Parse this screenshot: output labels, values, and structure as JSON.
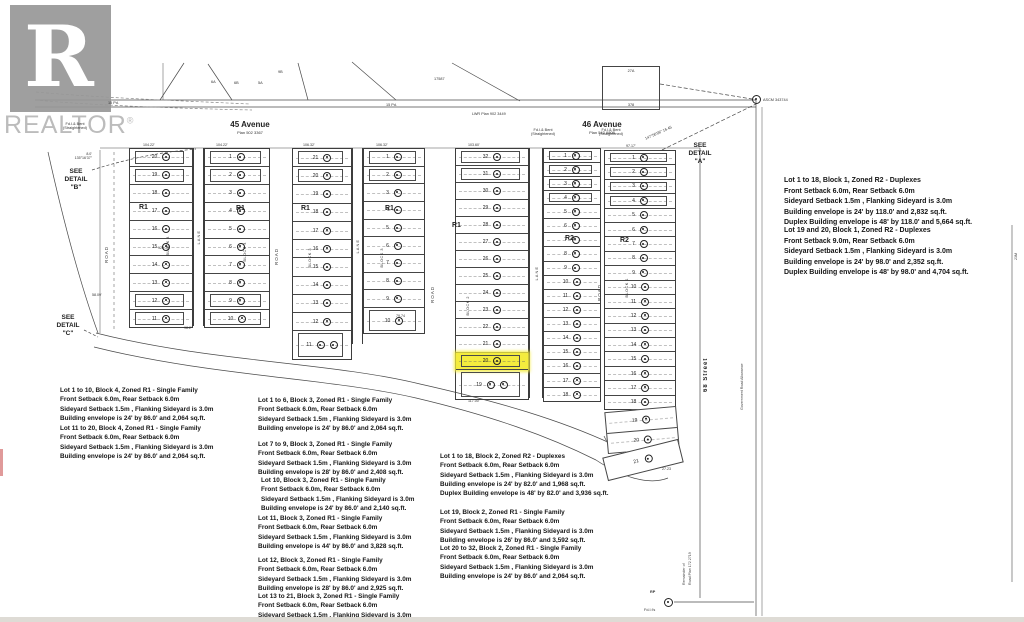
{
  "watermark": {
    "brand": "REALTOR",
    "registered": "®",
    "logo_letter": "R"
  },
  "labels": {
    "ave45": "45 Avenue",
    "plan45": "Plan 502 3367",
    "ave46": "46 Avenue",
    "plan46": "Plan 542 6808",
    "street68": "68 Street",
    "gov_road": "Government Road Allowance",
    "remainder": "Remainder of\nRoad Plan 172 2719",
    "lane": "LANE",
    "road": "ROAD",
    "det_a": "SEE\nDETAIL\n\"A\"",
    "det_b": "SEE\nDETAIL\n\"B\"",
    "det_c": "SEE\nDETAIL\n\"C\"",
    "lwr_plan": "LWR Plan 902 3449",
    "d17587": "17587",
    "box_top": "27A",
    "box_bot": "378",
    "ascm": "ASCM 343744",
    "bearing": "147°56'08\"  16.45",
    "fd_bent": "Fd.I.& Bent\n(Straightened)",
    "pd": "15 Pd.",
    "rp": "RP",
    "fdi": "Fd.I.t's",
    "d2723": "27.23",
    "d117": "117.00'",
    "d7974": "79.74",
    "d5809": "58.09'",
    "d982": "98.2'",
    "d12575": "125.75",
    "d8": "8.0'\n135°16'37\"",
    "m23": "23M",
    "top_dims": [
      "104.22'",
      "104.22'",
      "106.32'",
      "106.32'",
      "103.60'",
      "97.17'"
    ],
    "sub_lots": [
      "6A",
      "6B",
      "5A",
      "9B"
    ],
    "wedge_lot": "21"
  },
  "blocks": [
    {
      "label": "BLOCK 4",
      "zone": "R1",
      "left_lots": [
        "20",
        "19",
        "18",
        "17",
        "16",
        "15",
        "14",
        "13",
        "12",
        "11"
      ],
      "right_lots": [
        "1",
        "2",
        "3",
        "4",
        "5",
        "6",
        "7",
        "8",
        "9",
        "10"
      ]
    },
    {
      "label": "BLOCK 3",
      "zone": "R1",
      "left_lots": [
        "21",
        "20",
        "19",
        "18",
        "17",
        "16",
        "15",
        "14",
        "13",
        "12",
        "11"
      ],
      "right_lots": [
        "1",
        "2",
        "3",
        "4",
        "5",
        "6",
        "7",
        "8",
        "9",
        "10"
      ]
    },
    {
      "label": "BLOCK 2",
      "zone_left": "R1",
      "zone_right": "R2",
      "highlighted_lot": "20",
      "left_lots": [
        "32",
        "31",
        "30",
        "29",
        "28",
        "27",
        "26",
        "25",
        "24",
        "23",
        "22",
        "21",
        "20",
        "19"
      ],
      "right_lots": [
        "1",
        "2",
        "3",
        "4",
        "5",
        "6",
        "7",
        "8",
        "9",
        "10",
        "11",
        "12",
        "13",
        "14",
        "15",
        "16",
        "17",
        "18"
      ]
    },
    {
      "label": "BLOCK 1",
      "zone": "R2",
      "lots": [
        "1",
        "2",
        "3",
        "4",
        "5",
        "6",
        "7",
        "8",
        "9",
        "10",
        "11",
        "12",
        "13",
        "14",
        "15",
        "16",
        "17",
        "18"
      ],
      "bottom_lots": [
        "19",
        "20"
      ]
    }
  ],
  "notes": {
    "left": [
      "Lot 1 to 10, Block 4, Zoned R1 - Single Family\nFront Setback 6.0m, Rear Setback 6.0m\nSideyard Setback 1.5m , Flanking Sideyard is 3.0m\nBuilding envelope is 24' by 86.0'  and 2,064 sq.ft.",
      "Lot 11 to 20, Block 4, Zoned R1 - Single Family\nFront Setback 6.0m, Rear Setback 6.0m\nSideyard Setback 1.5m , Flanking Sideyard is 3.0m\nBuilding envelope is 24' by 86.0'  and 2,064 sq.ft."
    ],
    "mid": [
      "Lot 1 to 6, Block 3, Zoned R1 - Single Family\nFront Setback 6.0m, Rear Setback 6.0m\nSideyard Setback 1.5m , Flanking Sideyard is 3.0m\nBuilding envelope is 24' by 86.0'  and 2,064 sq.ft.",
      "Lot 7 to 9, Block 3, Zoned R1 - Single Family\nFront Setback 6.0m, Rear Setback 6.0m\nSideyard Setback 1.5m , Flanking Sideyard is 3.0m\nBuilding envelope is 28' by 86.0'  and 2,408 sq.ft.",
      "Lot 10, Block 3, Zoned R1 - Single Family\nFront Setback 6.0m, Rear Setback 6.0m\nSideyard Setback 1.5m , Flanking Sideyard is 3.0m\nBuilding envelope is 24' by 86.0'  and 2,140 sq.ft.",
      "Lot 11, Block 3, Zoned R1 - Single Family\nFront Setback 6.0m, Rear Setback 6.0m\nSideyard Setback 1.5m , Flanking Sideyard is 3.0m\nBuilding envelope is 44' by 86.0'  and 3,828 sq.ft.",
      "Lot 12, Block 3, Zoned R1 - Single Family\nFront Setback 6.0m, Rear Setback 6.0m\nSideyard Setback 1.5m , Flanking Sideyard is 3.0m\nBuilding envelope is 28' by 86.0'  and 2,925 sq.ft.",
      "Lot 13 to 21, Block 3, Zoned R1 - Single Family\nFront Setback 6.0m, Rear Setback 6.0m\nSideyard Setback 1.5m , Flanking Sideyard is 3.0m"
    ],
    "center": [
      "Lot 1 to 18, Block 2, Zoned R2 - Duplexes\nFront Setback 6.0m, Rear Setback 6.0m\nSideyard Setback 1.5m , Flanking Sideyard is 3.0m\nBuilding envelope is 24' by 82.0'  and 1,968 sq.ft.\nDuplex Building envelope is 48' by 82.0'  and 3,936 sq.ft.",
      "Lot 19, Block 2, Zoned R1 - Single Family\nFront Setback 6.0m, Rear Setback 6.0m\nSideyard Setback 1.5m , Flanking Sideyard is 3.0m\nBuilding envelope is 26' by 86.0'  and 3,592 sq.ft.",
      "Lot 20 to 32, Block 2, Zoned R1 - Single Family\nFront Setback 6.0m, Rear Setback 6.0m\nSideyard Setback 1.5m , Flanking Sideyard is 3.0m\nBuilding envelope is 24' by 86.0'  and 2,064 sq.ft."
    ],
    "right": [
      "Lot 1 to 18, Block 1, Zoned R2 - Duplexes\nFront Setback 6.0m, Rear Setback 6.0m\nSideyard Setback 1.5m , Flanking Sideyard is 3.0m\nBuilding envelope is 24' by 118.0'  and 2,832 sq.ft.\nDuplex Building envelope is 48' by 118.0'  and 5,664 sq.ft.",
      "Lot 19 and 20, Block 1, Zoned R2 - Duplexes\nFront Setback 9.0m, Rear Setback 6.0m\nSideyard Setback 1.5m , Flanking Sideyard is 3.0m\nBuilding envelope is 24' by 98.0'  and 2,352 sq.ft.\nDuplex Building envelope is 48' by 98.0'  and 4,704 sq.ft."
    ]
  },
  "colors": {
    "highlight": "#f4ec3e",
    "line": "#454545",
    "watermark": "#bcbcbc"
  }
}
